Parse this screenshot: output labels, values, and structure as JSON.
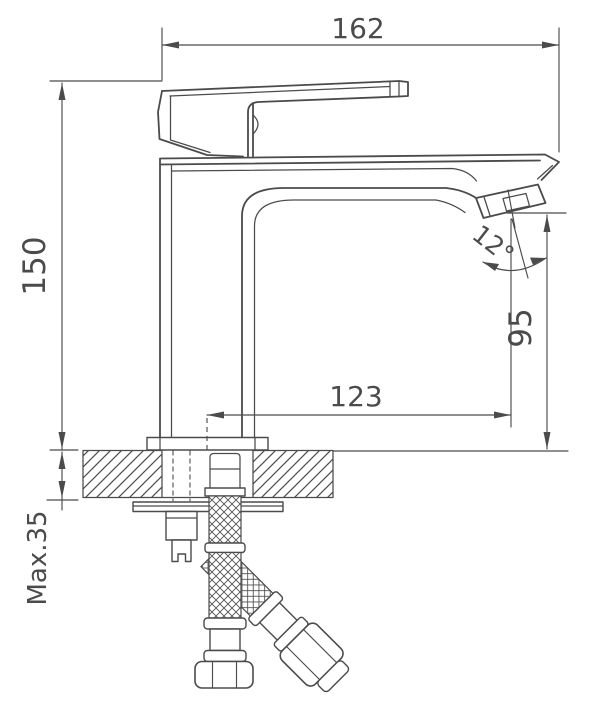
{
  "page": {
    "background": "#ffffff",
    "line_color": "#4b4b4b"
  },
  "drawing": {
    "type": "technical-installation-drawing",
    "subject": "single-lever basin mixer faucet, side elevation with mounting deck and flexible supply hoses"
  },
  "dimensions": {
    "top_width": "162",
    "height": "150",
    "spout_reach": "123",
    "spout_height": "95",
    "spout_angle": "12°",
    "max_deck_thickness": "Max.35"
  }
}
